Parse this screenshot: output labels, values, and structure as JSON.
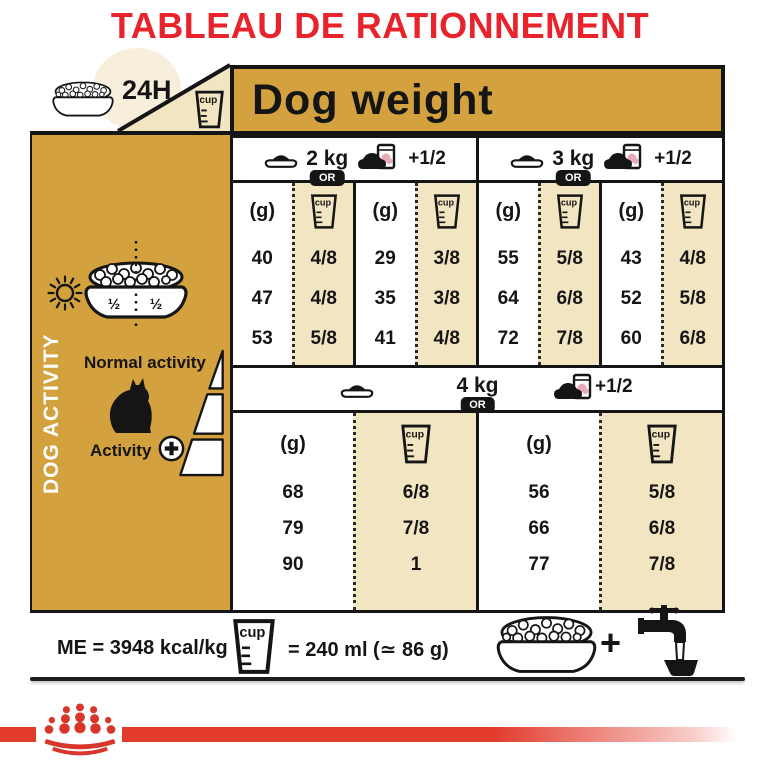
{
  "title": "TABLEAU DE RATIONNEMENT",
  "colors": {
    "gold": "#d3a23f",
    "cream": "#f2e5c1",
    "title_red": "#e8232b",
    "band_red": "#e23a2b"
  },
  "header": {
    "hours": "24H",
    "dog_weight": "Dog weight"
  },
  "labels": {
    "or": "OR",
    "g": "(g)",
    "cup": "cup",
    "plus_half": "+1/2"
  },
  "sidebar": {
    "vertical": "DOG ACTIVITY",
    "half_left": "½",
    "half_right": "½",
    "normal": "Normal activity",
    "activity": "Activity"
  },
  "section1": {
    "groups": [
      {
        "weight": "2 kg",
        "cols": [
          {
            "rows": [
              {
                "g": "40",
                "cup": "4/8"
              },
              {
                "g": "47",
                "cup": "4/8"
              },
              {
                "g": "53",
                "cup": "5/8"
              }
            ]
          },
          {
            "rows": [
              {
                "g": "29",
                "cup": "3/8"
              },
              {
                "g": "35",
                "cup": "3/8"
              },
              {
                "g": "41",
                "cup": "4/8"
              }
            ]
          }
        ]
      },
      {
        "weight": "3 kg",
        "cols": [
          {
            "rows": [
              {
                "g": "55",
                "cup": "5/8"
              },
              {
                "g": "64",
                "cup": "6/8"
              },
              {
                "g": "72",
                "cup": "7/8"
              }
            ]
          },
          {
            "rows": [
              {
                "g": "43",
                "cup": "4/8"
              },
              {
                "g": "52",
                "cup": "5/8"
              },
              {
                "g": "60",
                "cup": "6/8"
              }
            ]
          }
        ]
      }
    ]
  },
  "section2": {
    "weight": "4 kg",
    "cols": [
      {
        "rows": [
          {
            "g": "68",
            "cup": "6/8"
          },
          {
            "g": "79",
            "cup": "7/8"
          },
          {
            "g": "90",
            "cup": "1"
          }
        ]
      },
      {
        "rows": [
          {
            "g": "56",
            "cup": "5/8"
          },
          {
            "g": "66",
            "cup": "6/8"
          },
          {
            "g": "77",
            "cup": "7/8"
          }
        ]
      }
    ]
  },
  "footer": {
    "me": "ME = 3948 kcal/kg",
    "cup_equiv": "= 240 ml (≃ 86 g)",
    "plus": "+"
  }
}
